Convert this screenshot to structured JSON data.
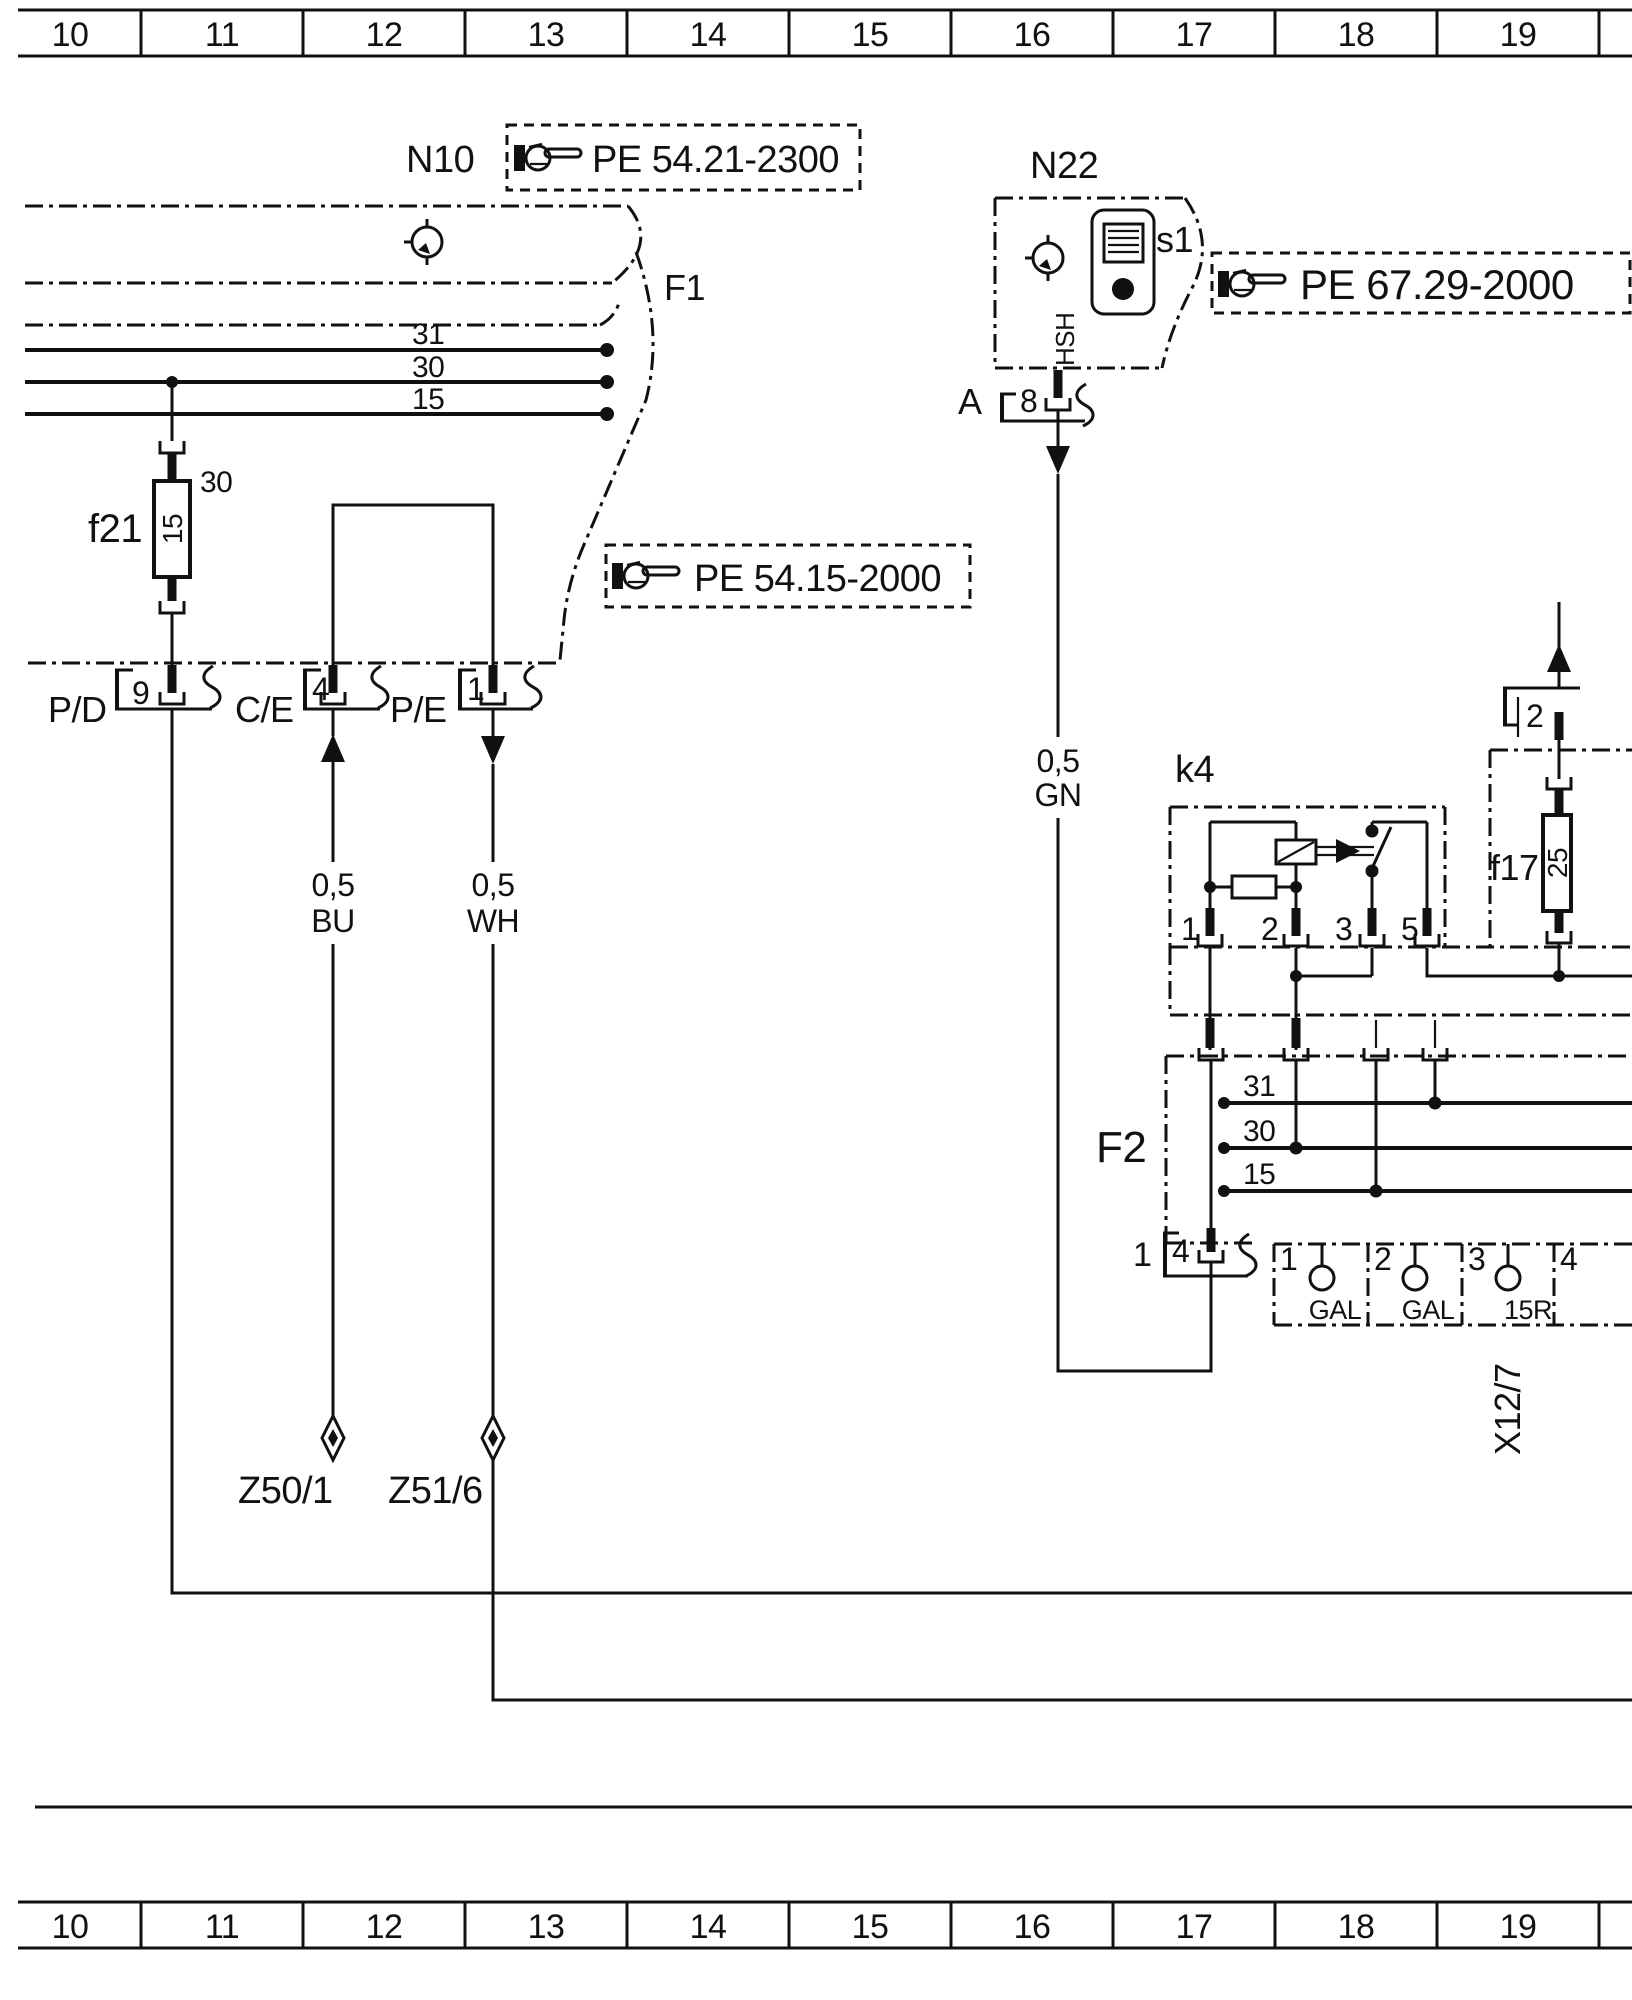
{
  "ruler": {
    "cells": [
      "10",
      "11",
      "12",
      "13",
      "14",
      "15",
      "16",
      "17",
      "18",
      "19"
    ]
  },
  "components": {
    "n10": "N10",
    "n22": "N22",
    "s1": "s1",
    "hsh": "HSH",
    "f1": "F1",
    "f2": "F2",
    "k4": "k4",
    "f21": {
      "label": "f21",
      "rating": "15",
      "circuit": "30"
    },
    "f17": {
      "label": "f17",
      "rating": "25"
    }
  },
  "references": {
    "pe_5421": "PE 54.21-2300",
    "pe_5415": "PE 54.15-2000",
    "pe_6729": "PE 67.29-2000"
  },
  "connectors": {
    "pd": {
      "label": "P/D",
      "pin": "9"
    },
    "ce": {
      "label": "C/E",
      "pin": "4"
    },
    "pe": {
      "label": "P/E",
      "pin": "1"
    },
    "a": {
      "label": "A",
      "pin": "8"
    },
    "f17_plug": {
      "pin": "2"
    },
    "f2_exit": {
      "outer": "1",
      "pin": "4"
    },
    "x127": {
      "label": "X12/7",
      "pins": [
        "1",
        "2",
        "3",
        "4"
      ],
      "functions": [
        "GAL",
        "GAL",
        "15R"
      ]
    }
  },
  "bus_left": [
    "31",
    "30",
    "15"
  ],
  "bus_f2": [
    "31",
    "30",
    "15"
  ],
  "k4_pins": [
    "1",
    "2",
    "3",
    "5"
  ],
  "wires": {
    "bu": {
      "size": "0,5",
      "color": "BU"
    },
    "wh": {
      "size": "0,5",
      "color": "WH"
    },
    "gn": {
      "size": "0,5",
      "color": "GN"
    }
  },
  "splices": {
    "z50_1": "Z50/1",
    "z51_6": "Z51/6"
  }
}
